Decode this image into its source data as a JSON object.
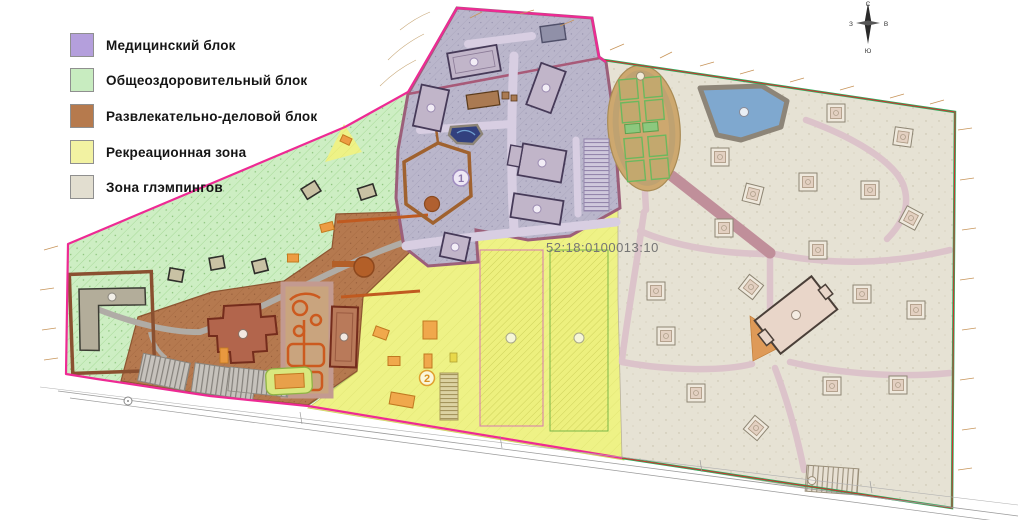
{
  "legend": {
    "items": [
      {
        "label": "Медицинский блок",
        "color": "#b49fdc"
      },
      {
        "label": "Общеоздоровительный блок",
        "color": "#c8ecc0"
      },
      {
        "label": "Развлекательно-деловой блок",
        "color": "#b67a4d"
      },
      {
        "label": "Рекреационная зона",
        "color": "#f2f2a2"
      },
      {
        "label": "Зона глэмпингов",
        "color": "#e2ded0"
      }
    ]
  },
  "compass": {
    "north": "С",
    "south": "Ю",
    "west": "З",
    "east": "В"
  },
  "map": {
    "cadastral_number": "52:18:0100013:10",
    "zone_labels": [
      {
        "text": "1"
      },
      {
        "text": "2"
      }
    ],
    "colors": {
      "boundary_magenta": "#ee2a94",
      "boundary_green": "#2fae5e",
      "boundary_red": "#d03030",
      "medical_zone": "#bab6cb",
      "health_zone": "#cdeec3",
      "business_zone": "#b5794f",
      "recreation_zone": "#eef286",
      "glamping_zone": "#e6e2d4",
      "water": "#7fa8cf",
      "stadium_track": "#cda86f",
      "glamping_path": "#dcc3ca",
      "road": "#b3afa8"
    }
  }
}
